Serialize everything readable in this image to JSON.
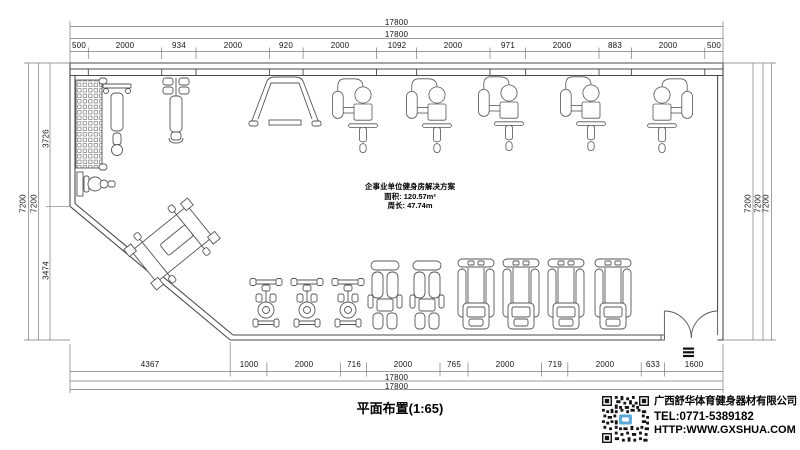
{
  "plan": {
    "title": "企事业单位健身房解决方案",
    "area": "面积: 120.57m²",
    "perimeter": "周长: 47.74m",
    "caption": "平面布置(1:65)"
  },
  "dimensions": {
    "top_total_outer": "17800",
    "top_total_inner": "17800",
    "top_segments": [
      "500",
      "2000",
      "934",
      "2000",
      "920",
      "2000",
      "1092",
      "2000",
      "971",
      "2000",
      "883",
      "2000",
      "500"
    ],
    "bottom_segments": [
      "4367",
      "1000",
      "2000",
      "716",
      "2000",
      "765",
      "2000",
      "719",
      "2000",
      "633",
      "1600"
    ],
    "bottom_total_inner": "17800",
    "bottom_total_outer": "17800",
    "left_outer": "7200",
    "left_inner": "7200",
    "left_upper": "3726",
    "left_lower": "3474",
    "right_1": "7200",
    "right_2": "7200",
    "right_3": "7200"
  },
  "company": {
    "name": "广西舒华体育健身器材有限公司",
    "tel": "TEL:0771-5389182",
    "website": "HTTP:WWW.GXSHUA.COM"
  },
  "icons": {
    "qr_code": "qr-code",
    "entrance_mark": "entrance-mat"
  },
  "colors": {
    "wall_line": "#4a4a4a",
    "dim_line": "#7a7a7a",
    "text": "#000000",
    "qr_center": "#59a8d8",
    "background": "#ffffff"
  }
}
